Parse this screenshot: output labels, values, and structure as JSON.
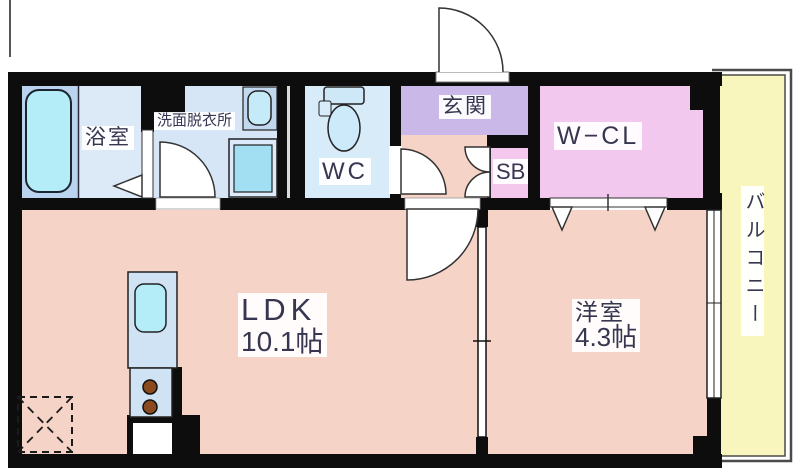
{
  "floorplan": {
    "labels": {
      "bathroom": "浴室",
      "washroom": "洗面脱衣所",
      "wc": "WC",
      "entrance": "玄関",
      "shoebox": "SB",
      "walkin_closet": "W−CL",
      "ldk_name": "LDK",
      "ldk_size": "10.1帖",
      "bedroom_name": "洋室",
      "bedroom_size": "4.3帖",
      "balcony": "バルコニー"
    },
    "colors": {
      "wall": "#0d0d0d",
      "living_floor": "#f6d3c7",
      "entrance_floor": "#cab8e9",
      "closet_floor": "#f3c8ee",
      "bathroom_floor": "#dce9f7",
      "tub_alcove": "#bad3ee",
      "washroom_floor": "#d6e6f7",
      "wc_floor": "#d8ebf9",
      "water_fixture": "#b4ecf8",
      "washer_pan_inner": "#a2dff2",
      "kitchen_counter": "#cfe3f5",
      "balcony_floor": "#f9f6bd",
      "burner": "#8b4a1d",
      "label_text": "#363650"
    }
  }
}
